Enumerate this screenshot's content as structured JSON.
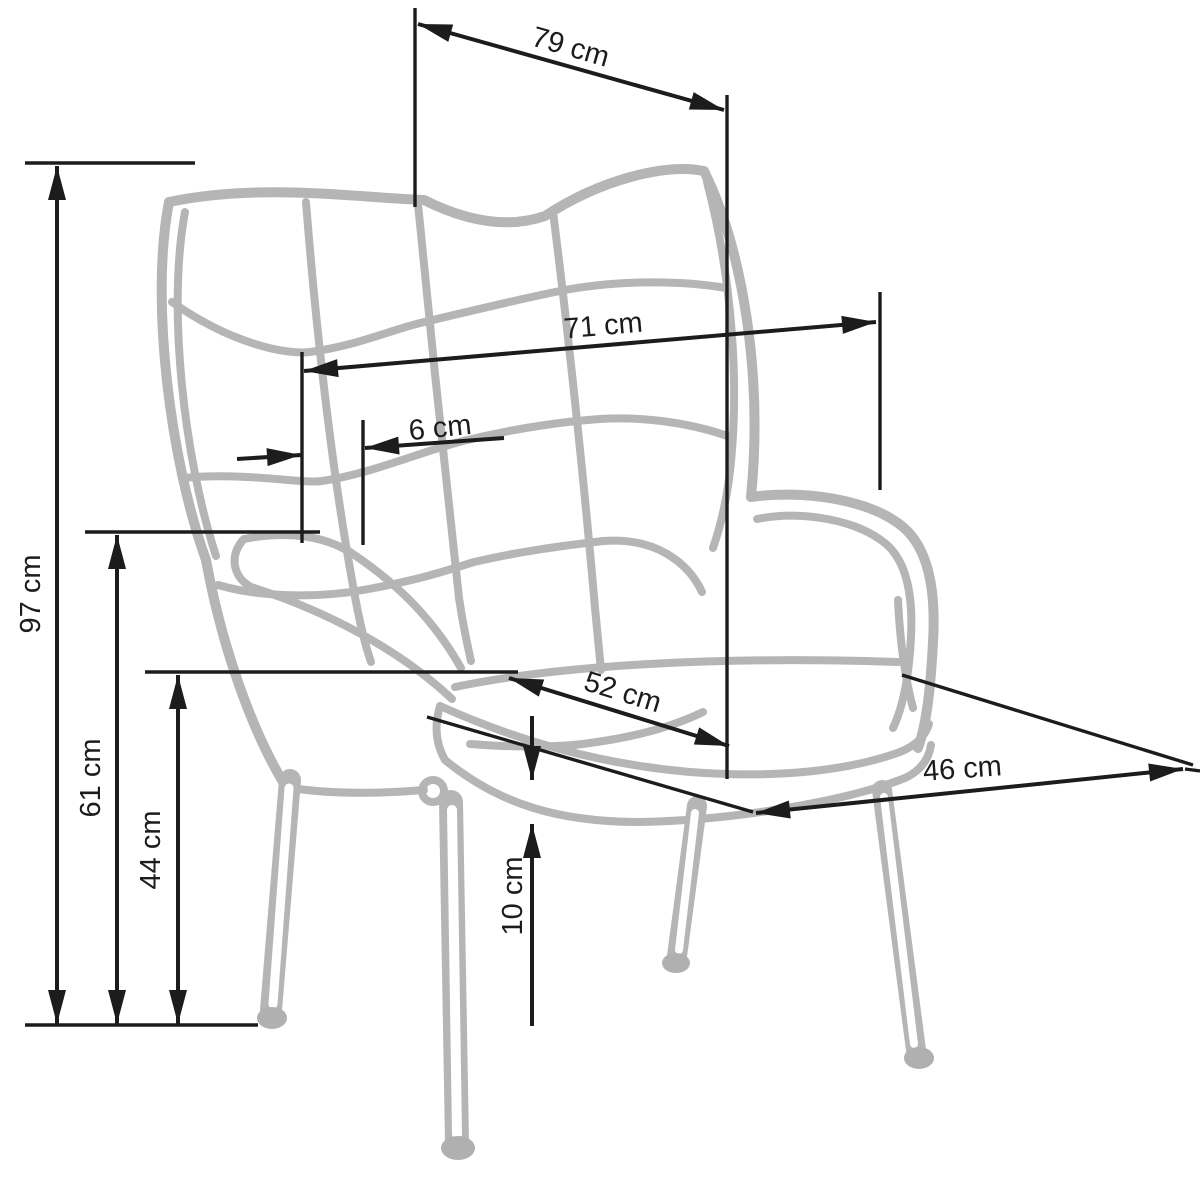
{
  "diagram": {
    "type": "furniture-dimension-drawing",
    "subject": "wingback armchair outline sketch with dimension arrows",
    "unit": "cm",
    "background_color": "#ffffff",
    "sketch_color": "#b5b5b5",
    "dimension_color": "#1c1c1c",
    "dimensions": {
      "top_depth": {
        "label": "79 cm",
        "value": 79
      },
      "back_width": {
        "label": "71 cm",
        "value": 71
      },
      "back_offset": {
        "label": "6 cm",
        "value": 6
      },
      "total_height": {
        "label": "97 cm",
        "value": 97
      },
      "armrest_height": {
        "label": "61 cm",
        "value": 61
      },
      "seat_height": {
        "label": "44 cm",
        "value": 44
      },
      "seat_depth": {
        "label": "52 cm",
        "value": 52
      },
      "seat_width": {
        "label": "46 cm",
        "value": 46
      },
      "cushion_thickness": {
        "label": "10 cm",
        "value": 10
      }
    }
  }
}
